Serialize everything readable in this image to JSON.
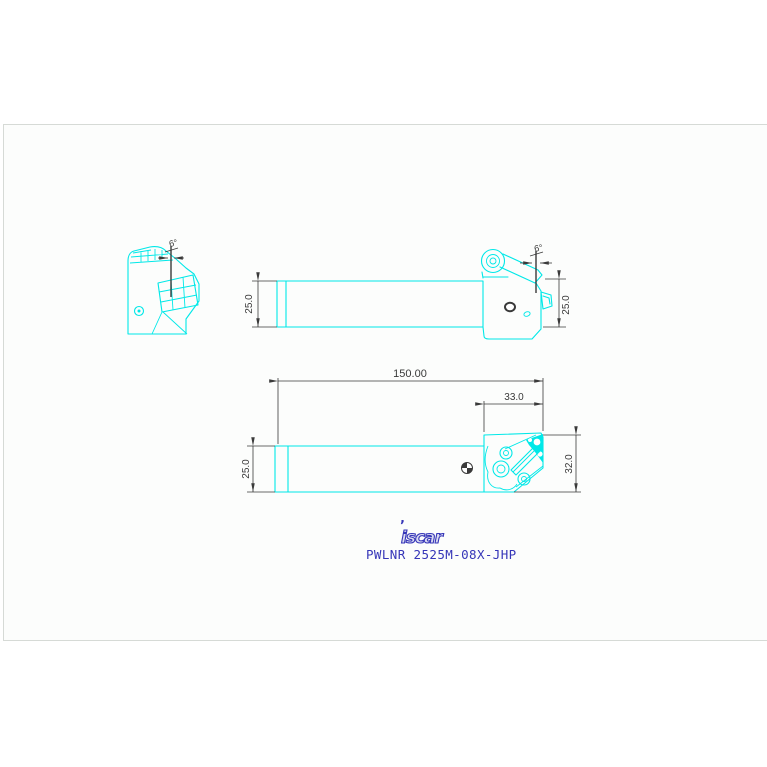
{
  "drawing": {
    "side_view": {
      "angle": "6°"
    },
    "top_view": {
      "angle": "6°",
      "height_left": "25.0",
      "height_right": "25.0"
    },
    "front_view": {
      "overall_length": "150.00",
      "head_length": "33.0",
      "shank_height": "25.0",
      "head_height": "32.0"
    }
  },
  "footer": {
    "brand": "iscar",
    "brand_mark": "’",
    "part_number": "PWLNR 2525M-08X-JHP"
  },
  "colors": {
    "line": "#00e8e8",
    "dim": "#3a3a3a",
    "brand": "#3636b8",
    "sheet_border": "#d6dad6",
    "sheet_bg": "#fcfdfc"
  }
}
